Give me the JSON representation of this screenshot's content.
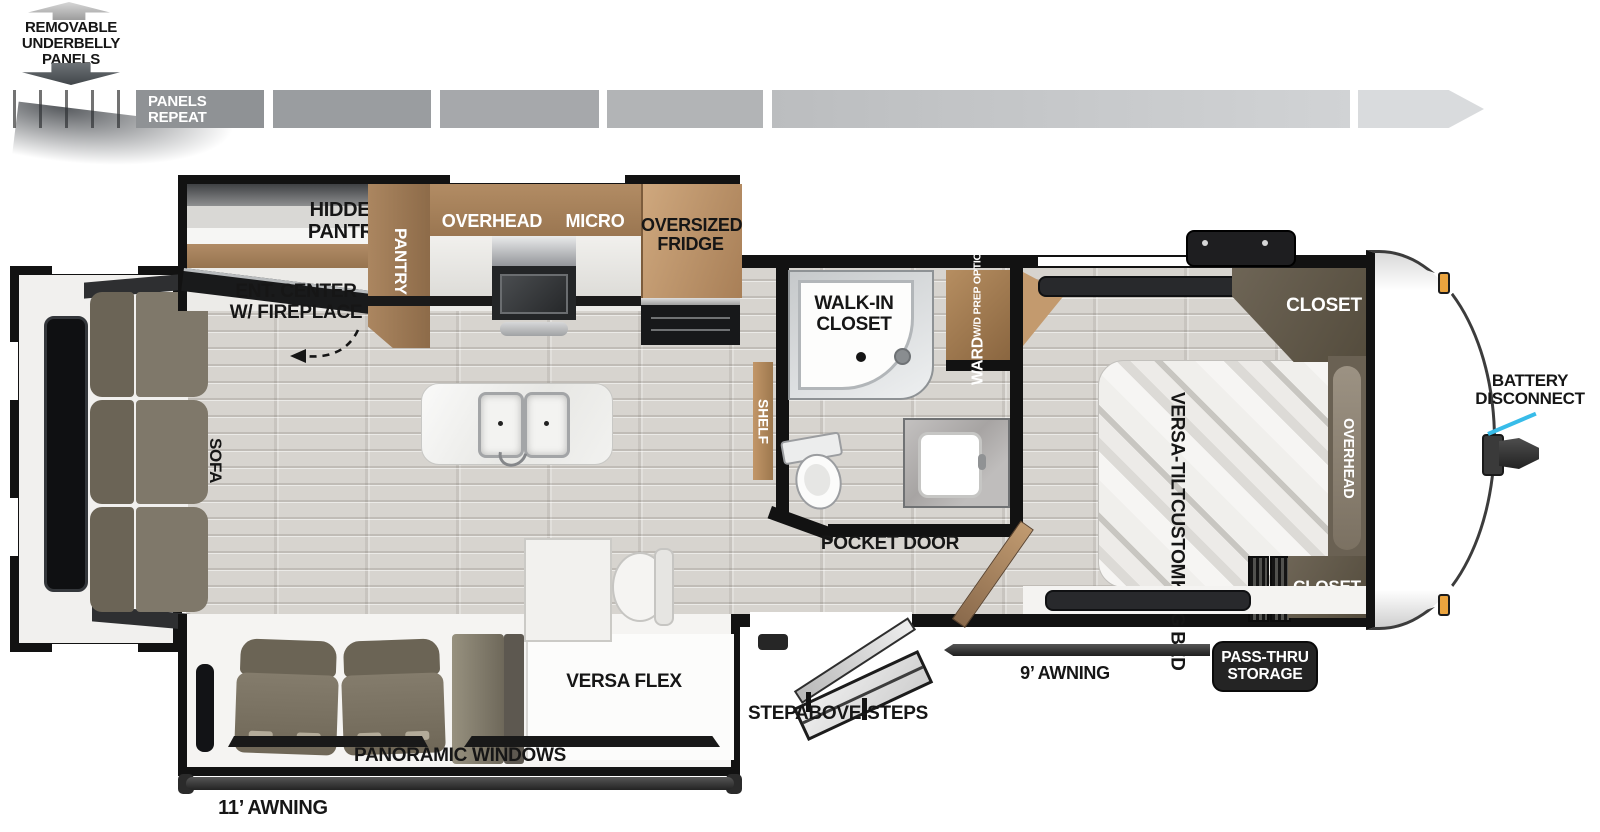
{
  "legend": {
    "lines": [
      "REMOVABLE",
      "UNDERBELLY",
      "PANELS"
    ],
    "panels_repeat": [
      "PANELS",
      "REPEAT"
    ]
  },
  "kitchen": {
    "hidden_pantry": [
      "HIDDEN",
      "PANTRY"
    ],
    "pantry": "PANTRY",
    "overhead": "OVERHEAD",
    "micro": "MICRO",
    "fridge": [
      "OVERSIZED",
      "FRIDGE"
    ],
    "ent_center": [
      "ENT. CENTER",
      "W/ FIREPLACE"
    ]
  },
  "living": {
    "sofa": "SOFA",
    "shelf": "SHELF",
    "versa_flex": "VERSA FLEX",
    "panoramic": "PANORAMIC WINDOWS",
    "awning11": "11’ AWNING"
  },
  "bath": {
    "walk_in": [
      "WALK-IN",
      "CLOSET"
    ],
    "ward": "WARD",
    "wd_prep": "W/D PREP OPTION",
    "pocket_door": "POCKET DOOR"
  },
  "bedroom": {
    "bed": [
      "VERSA-TILT",
      "CUSTOM",
      "KING BED"
    ],
    "closet_top": "CLOSET",
    "closet_bottom": "CLOSET",
    "overhead": "OVERHEAD"
  },
  "exterior": {
    "battery": [
      "BATTERY",
      "DISCONNECT"
    ],
    "pass_thru": [
      "PASS-THRU",
      "STORAGE"
    ],
    "awning9": "9’ AWNING",
    "steps": "STEPABOVE-STEPS"
  },
  "colors": {
    "wall": "#121212",
    "floor": "#d7d4cf",
    "cabinet_brown": "#a3805d",
    "fridge_wood": "#c49c74",
    "dark_cabinet": "#5f5748",
    "sofa": "#7f786a",
    "accent_cyan": "#38bce9",
    "awning": "#2e2e2e",
    "marker_light": "#eba43e"
  }
}
